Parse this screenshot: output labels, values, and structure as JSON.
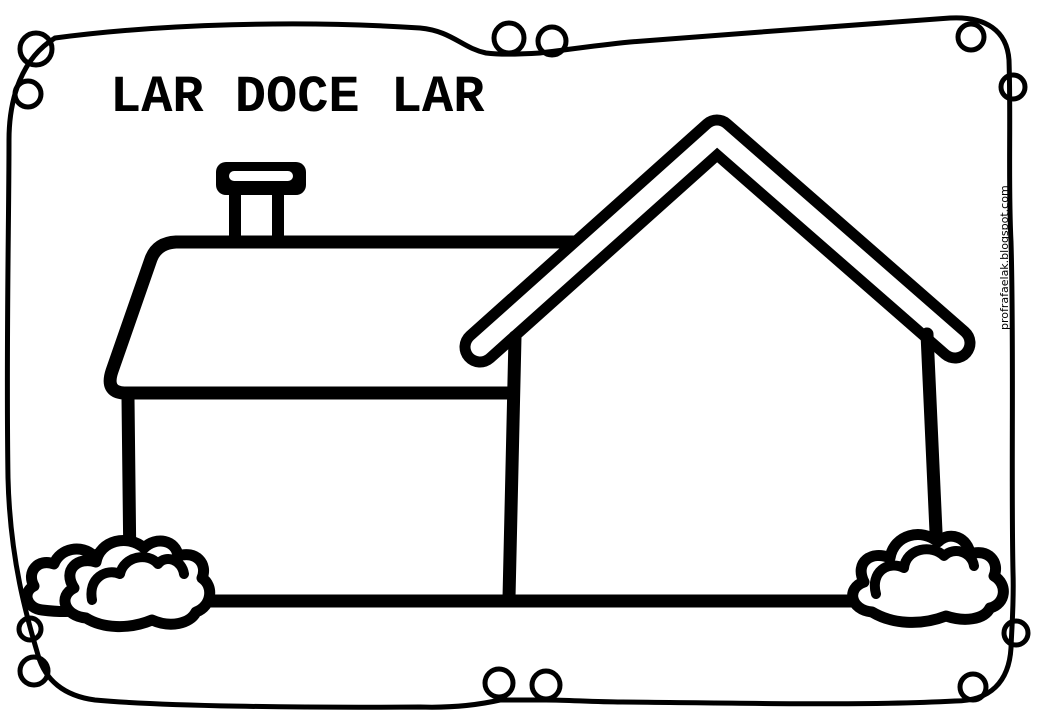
{
  "colors": {
    "ink": "#000000",
    "paper": "#ffffff"
  },
  "title": {
    "text": "LAR DOCE LAR"
  },
  "watermark": {
    "text": "profrafaelak.blogspot.com"
  },
  "drawing": {
    "name": "house-coloring-page",
    "parts": [
      "decorative-loop-border",
      "chimney",
      "small-house-roof",
      "small-house-wall",
      "large-house-roof-band",
      "large-house-walls",
      "ground-line",
      "left-back-bush",
      "left-front-bush",
      "right-bush"
    ]
  }
}
